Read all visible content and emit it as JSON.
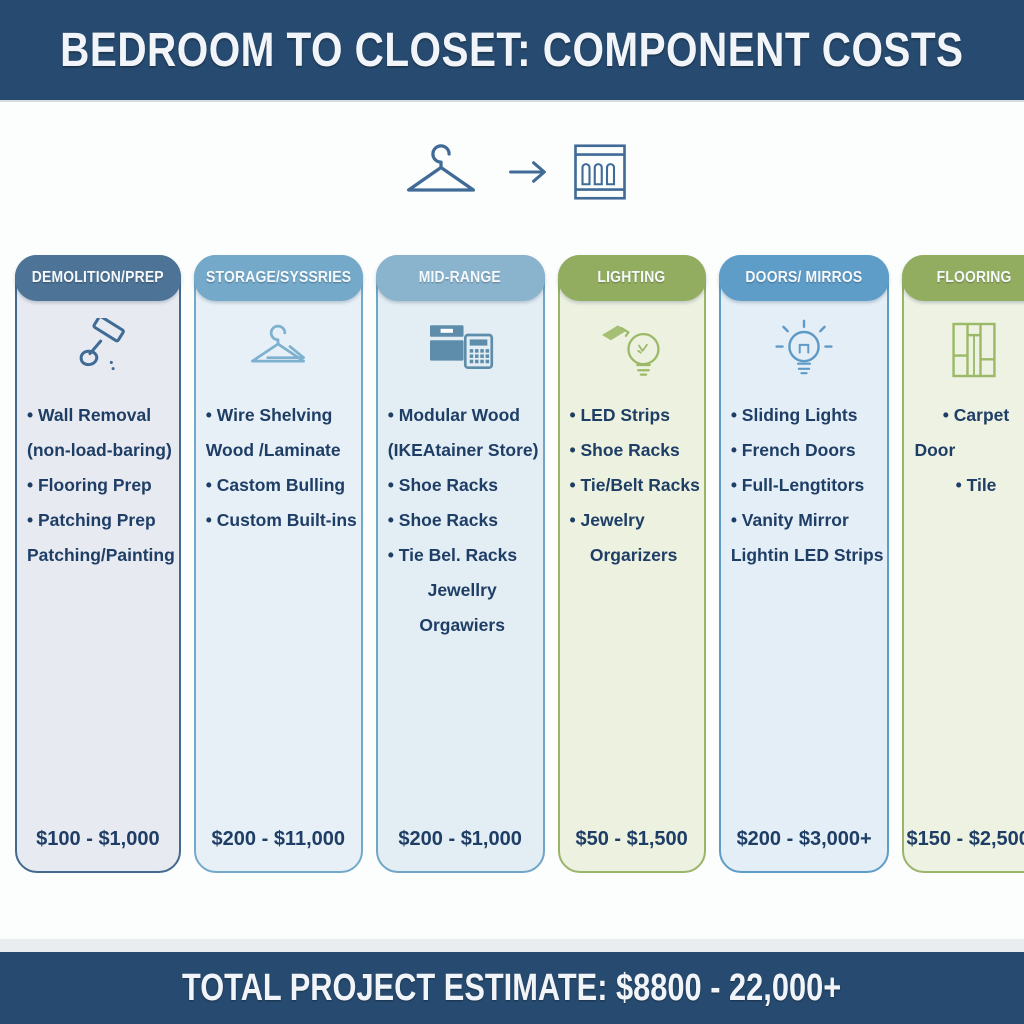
{
  "header": {
    "title": "BEDROOM TO CLOSET: COMPONENT COSTS",
    "bg_color": "#274b70"
  },
  "transformation": {
    "from_icon": "hanger-icon",
    "arrow_icon": "arrow-right-icon",
    "to_icon": "closet-icon",
    "color": "#3f6b96"
  },
  "columns": [
    {
      "header": "DEMOLITION/PREP",
      "icon": "demolition-hammer-icon",
      "price": "$100 - $1,000",
      "colors": {
        "header_bg": "#4d7396",
        "border": "#44698e",
        "body_bg": "#e8eaf1",
        "icon": "#3f6b96"
      },
      "items": [
        {
          "text": "Wall Removal",
          "bullet": true,
          "align": "left"
        },
        {
          "text": "(non-load-baring)",
          "bullet": false,
          "align": "left"
        },
        {
          "text": "Flooring Prep",
          "bullet": true,
          "align": "left"
        },
        {
          "text": "Patching Prep",
          "bullet": true,
          "align": "left"
        },
        {
          "text": "Patching/Painting",
          "bullet": false,
          "align": "left"
        }
      ]
    },
    {
      "header": "STORAGE/SYSSRIES",
      "icon": "hangers-icon",
      "price": "$200 - $11,000",
      "colors": {
        "header_bg": "#74a9ca",
        "border": "#74a9ca",
        "body_bg": "#e7f0f7",
        "icon": "#7eb0d0"
      },
      "items": [
        {
          "text": "Wire Shelving",
          "bullet": true,
          "align": "left"
        },
        {
          "text": "Wood /Laminate",
          "bullet": false,
          "align": "left"
        },
        {
          "text": "Castom Bulling",
          "bullet": true,
          "align": "left"
        },
        {
          "text": "Custom Built-ins",
          "bullet": true,
          "align": "left"
        }
      ]
    },
    {
      "header": "MID-RANGE",
      "icon": "storage-boxes-icon",
      "price": "$200 - $1,000",
      "colors": {
        "header_bg": "#8ab4ce",
        "border": "#6fa5c6",
        "body_bg": "#e3edf4",
        "icon": "#5e8cab"
      },
      "items": [
        {
          "text": "Modular Wood",
          "bullet": true,
          "align": "left"
        },
        {
          "text": "(IKEAtainer Store)",
          "bullet": false,
          "align": "left"
        },
        {
          "text": "Shoe Racks",
          "bullet": true,
          "align": "left"
        },
        {
          "text": "Shoe Racks",
          "bullet": true,
          "align": "left"
        },
        {
          "text": "Tie Bel. Racks",
          "bullet": true,
          "align": "left"
        },
        {
          "text": "Jewellry",
          "bullet": false,
          "align": "center"
        },
        {
          "text": "Orgawiers",
          "bullet": false,
          "align": "center"
        }
      ]
    },
    {
      "header": "LIGHTING",
      "icon": "led-bulb-icon",
      "price": "$50 - $1,500",
      "colors": {
        "header_bg": "#93ad60",
        "border": "#9ab46a",
        "body_bg": "#edf1e0",
        "icon": "#9cb968"
      },
      "items": [
        {
          "text": "LED Strips",
          "bullet": true,
          "align": "left"
        },
        {
          "text": "Shoe Racks",
          "bullet": true,
          "align": "left"
        },
        {
          "text": "Tie/Belt Racks",
          "bullet": true,
          "align": "left"
        },
        {
          "text": "Jewelry",
          "bullet": true,
          "align": "left"
        },
        {
          "text": "Orgarizers",
          "bullet": false,
          "align": "center"
        }
      ]
    },
    {
      "header": "DOORS/ MIRROS",
      "icon": "bulb-rays-icon",
      "price": "$200 - $3,000+",
      "colors": {
        "header_bg": "#5f9dc9",
        "border": "#5f9dc9",
        "body_bg": "#e3eef7",
        "icon": "#5f9ac7"
      },
      "items": [
        {
          "text": "Sliding Lights",
          "bullet": true,
          "align": "left"
        },
        {
          "text": "French Doors",
          "bullet": true,
          "align": "left"
        },
        {
          "text": "Full-Lengtitors",
          "bullet": true,
          "align": "left"
        },
        {
          "text": "Vanity Mirror",
          "bullet": true,
          "align": "left"
        },
        {
          "text": "Lightin LED Strips",
          "bullet": false,
          "align": "left"
        }
      ]
    },
    {
      "header": "FLOORING",
      "icon": "floor-tile-icon",
      "price": "$150 - $2,500+",
      "colors": {
        "header_bg": "#93ad60",
        "border": "#9ab46a",
        "body_bg": "#eef2e2",
        "icon": "#9cb968"
      },
      "items": [
        {
          "text": "Carpet",
          "bullet": true,
          "align": "center"
        },
        {
          "text": "Door",
          "bullet": false,
          "align": "left"
        },
        {
          "text": "Tile",
          "bullet": true,
          "align": "center"
        }
      ]
    }
  ],
  "footer": {
    "title": "TOTAL PROJECT ESTIMATE: $8800 - 22,000+",
    "bg_color": "#274b70"
  }
}
